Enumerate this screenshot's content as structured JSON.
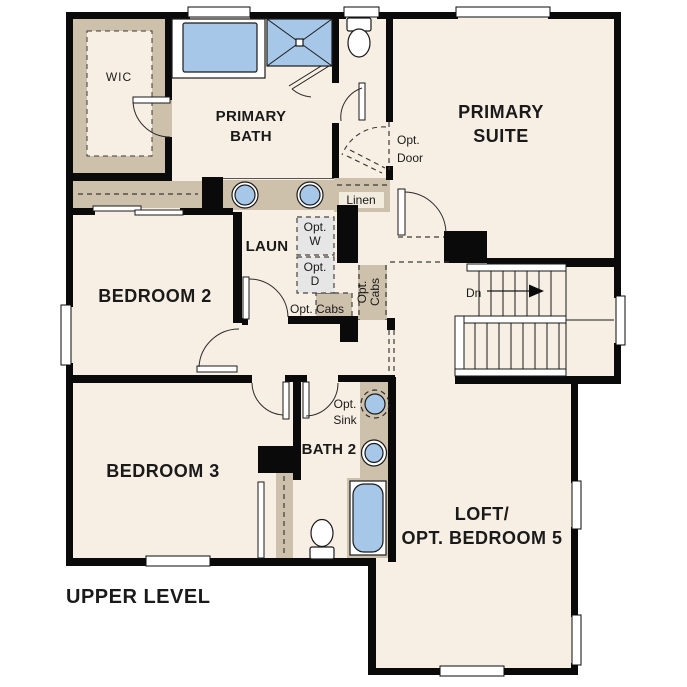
{
  "title": {
    "plan_label": "UPPER LEVEL"
  },
  "colors": {
    "floor": "#f7efe3",
    "wall": "#0a0a0a",
    "cabinet_tan": "#cdc1ab",
    "fixture_blue": "#a6c7e7",
    "appliance_gray": "#e6e6e6",
    "background": "#ffffff"
  },
  "rooms": {
    "wic": "WIC",
    "primary_bath": [
      "PRIMARY",
      "BATH"
    ],
    "primary_suite": [
      "PRIMARY",
      "SUITE"
    ],
    "bedroom2": "BEDROOM 2",
    "bedroom3": "BEDROOM 3",
    "bath2": "BATH 2",
    "laundry": "LAUN",
    "loft": [
      "LOFT/",
      "OPT. BEDROOM 5"
    ]
  },
  "annotations": {
    "opt_washer": [
      "Opt.",
      "W"
    ],
    "opt_dryer": [
      "Opt.",
      "D"
    ],
    "opt_cabs_hall": "Opt. Cabs",
    "opt_cabs_vert": [
      "Opt.",
      "Cabs"
    ],
    "linen": "Linen",
    "opt_door": [
      "Opt.",
      "Door"
    ],
    "opt_sink": [
      "Opt.",
      "Sink"
    ],
    "stairs_down": "Dn"
  }
}
